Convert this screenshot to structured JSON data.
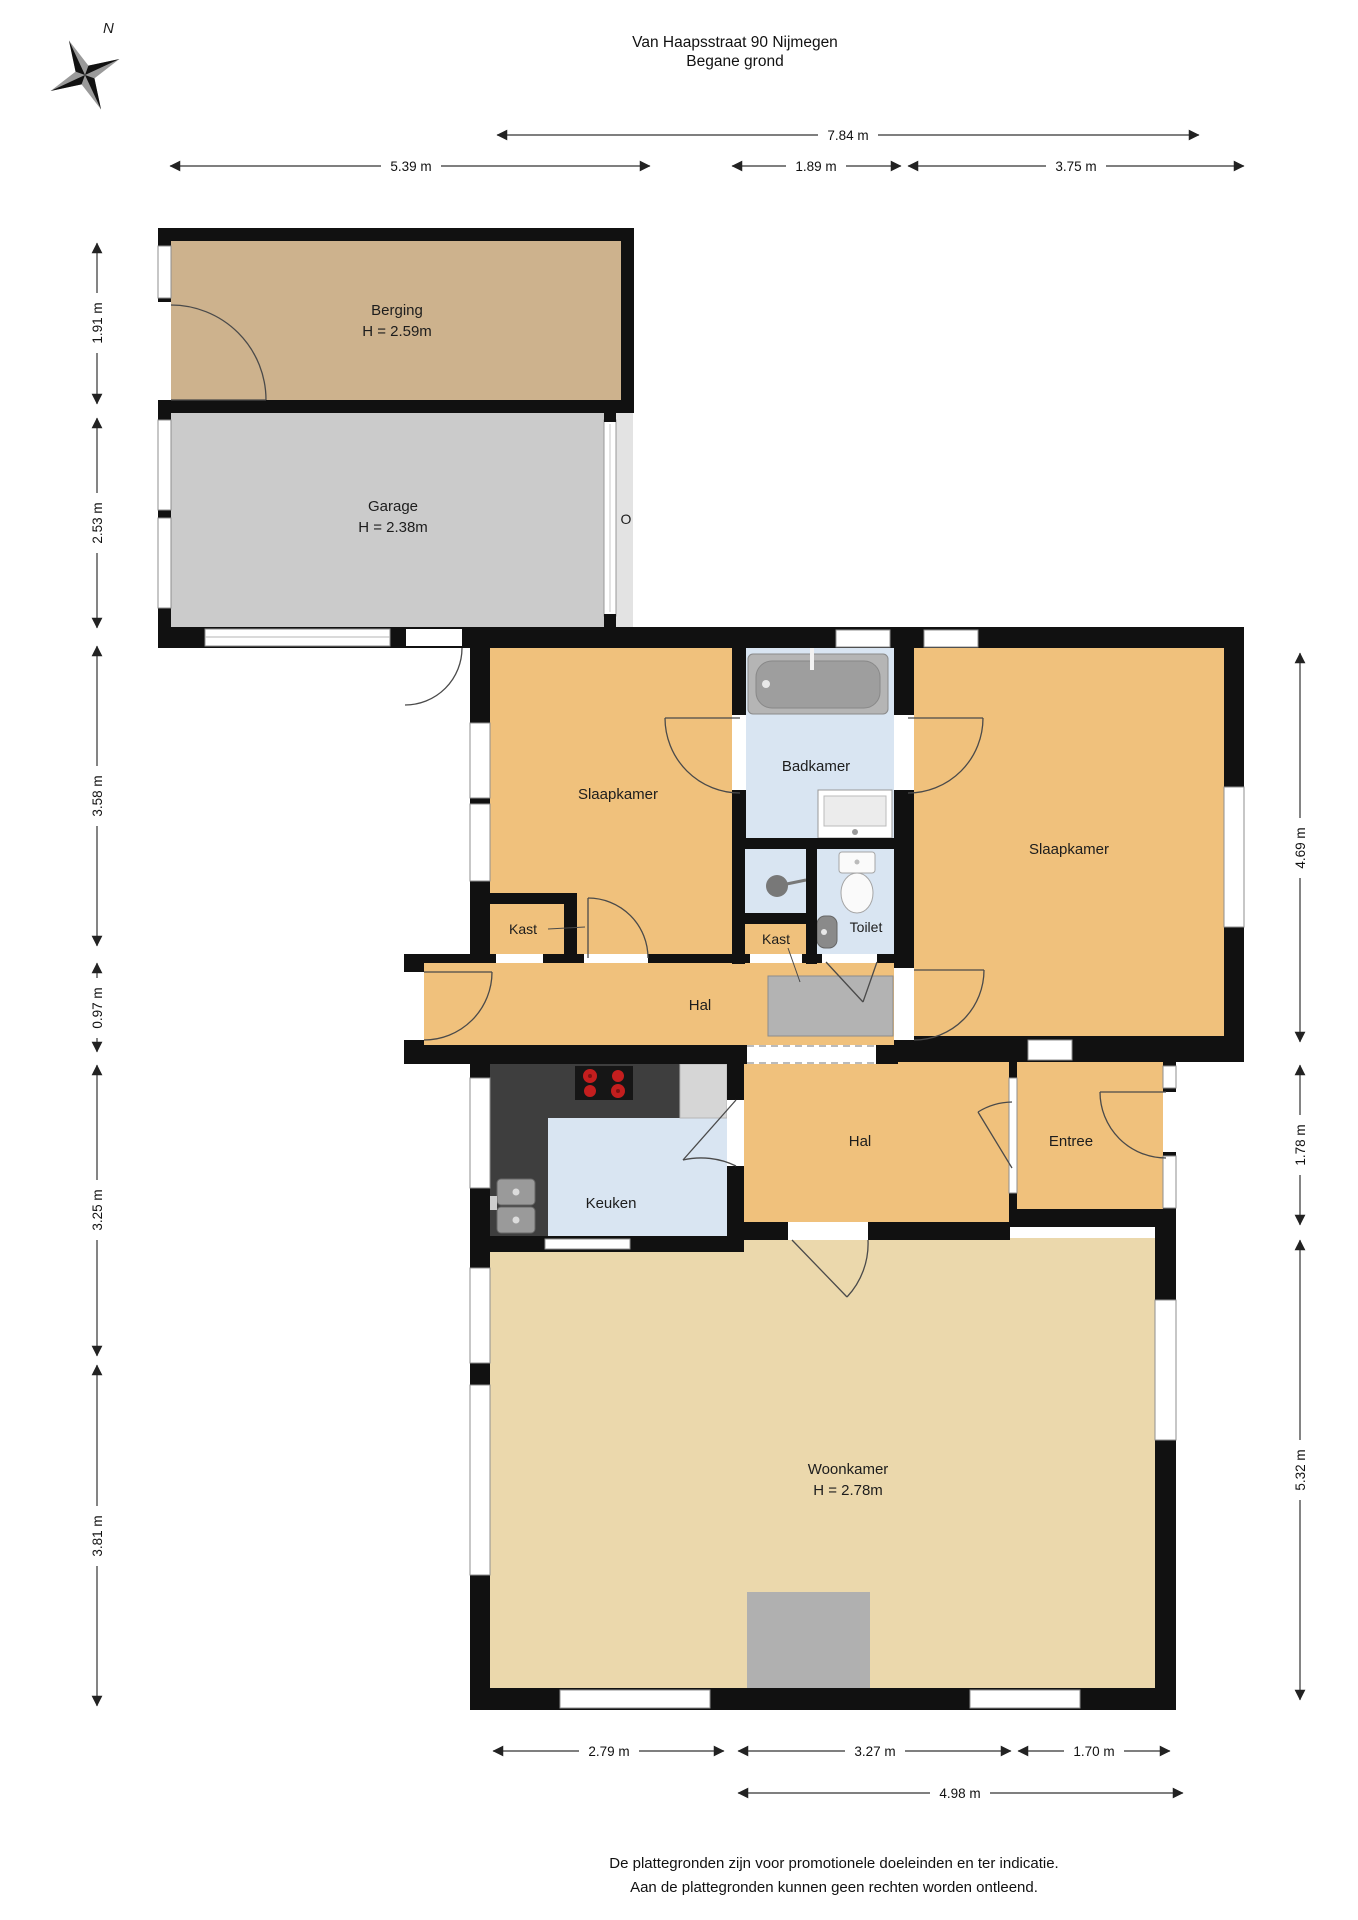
{
  "title": {
    "line1": "Van Haapsstraat 90 Nijmegen",
    "line2": "Begane grond"
  },
  "compass": {
    "label": "N"
  },
  "rooms": {
    "berging": {
      "name": "Berging",
      "height": "H = 2.59m"
    },
    "garage": {
      "name": "Garage",
      "height": "H = 2.38m"
    },
    "slaapkamer_left": {
      "name": "Slaapkamer"
    },
    "badkamer": {
      "name": "Badkamer"
    },
    "slaapkamer_right": {
      "name": "Slaapkamer"
    },
    "kast_left": {
      "name": "Kast"
    },
    "kast_middle": {
      "name": "Kast"
    },
    "toilet": {
      "name": "Toilet"
    },
    "hal_upper": {
      "name": "Hal"
    },
    "hal_lower": {
      "name": "Hal"
    },
    "entree": {
      "name": "Entree"
    },
    "keuken": {
      "name": "Keuken"
    },
    "woonkamer": {
      "name": "Woonkamer",
      "height": "H = 2.78m"
    }
  },
  "markers": {
    "garage_side_door": "O"
  },
  "dimensions": {
    "top": [
      "7.84 m"
    ],
    "top_row2": [
      "5.39 m",
      "1.89 m",
      "3.75 m"
    ],
    "left": [
      "1.91 m",
      "2.53 m",
      "3.58 m",
      "0.97 m",
      "3.25 m",
      "3.81 m"
    ],
    "right": [
      "4.69 m",
      "1.78 m",
      "5.32 m"
    ],
    "bottom": [
      "2.79 m",
      "3.27 m",
      "1.70 m"
    ],
    "bottom_row2": [
      "4.98 m"
    ]
  },
  "footer": {
    "line1": "De plattegronden zijn voor promotionele doeleinden en ter indicatie.",
    "line2": "Aan de plattegronden kunnen geen rechten worden ontleend."
  },
  "colors": {
    "wall": "#111111",
    "room_orange": "#f0c17c",
    "room_living": "#ebd8ac",
    "room_wet": "#d9e5f2",
    "berging": "#cdb28d",
    "garage": "#cbcbcb",
    "counter": "#3e3e3e",
    "burner_red": "#c41e1e",
    "mat_gray": "#b3b3b3"
  }
}
